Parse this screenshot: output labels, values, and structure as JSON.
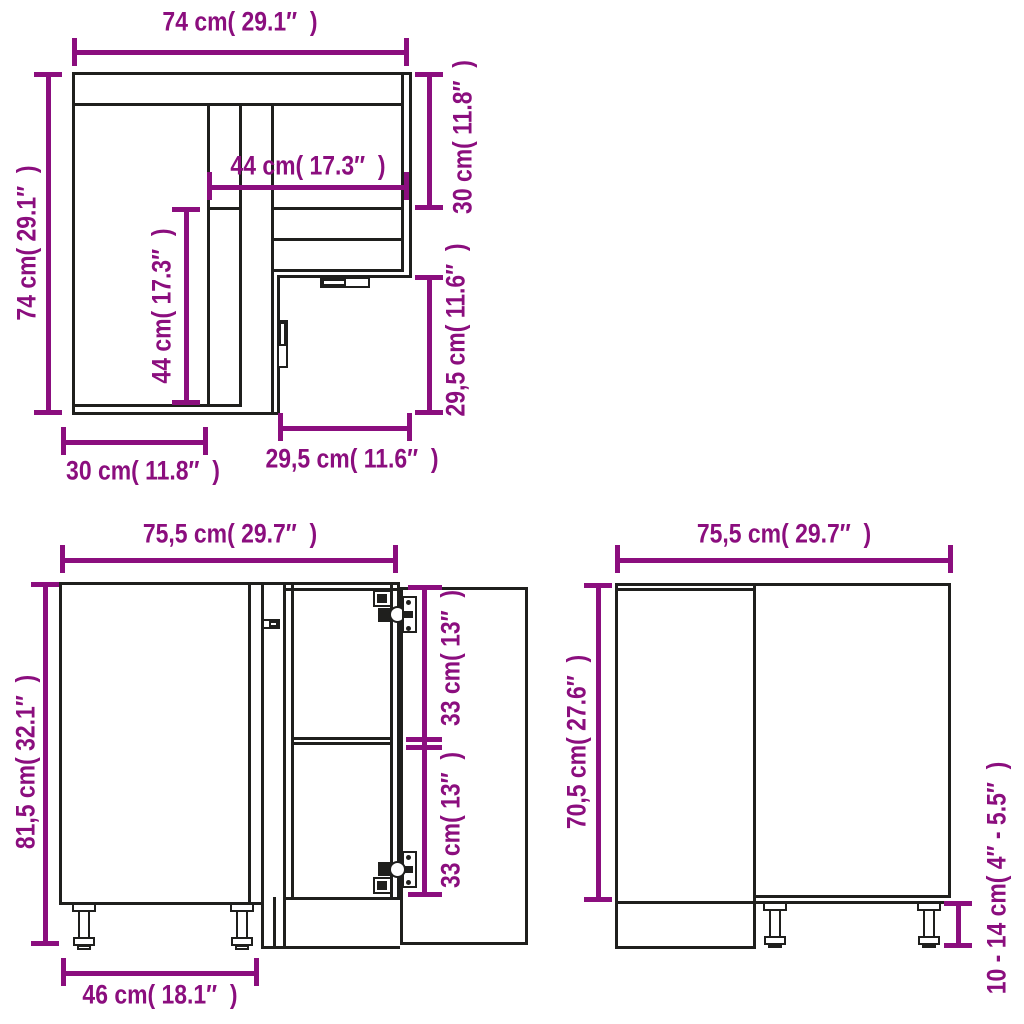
{
  "colors": {
    "dimension": "#8b0e7e",
    "line": "#1f1f1d",
    "background": "#ffffff"
  },
  "views": {
    "top": {
      "outer_width": "74 cm( 29.1″  )",
      "outer_depth": "74 cm( 29.1″  )",
      "inner_width": "44 cm( 17.3″  )",
      "inner_depth": "44 cm( 17.3″  )",
      "right_depth": "30 cm( 11.8″  )",
      "right_front": "29,5 cm( 11.6″  )",
      "bottom_left": "30 cm( 11.8″  )",
      "bottom_right": "29,5 cm( 11.6″  )"
    },
    "front": {
      "width": "75,5 cm( 29.7″  )",
      "height": "81,5 cm( 32.1″  )",
      "hinge_upper": "33 cm( 13″  )",
      "hinge_lower": "33 cm( 13″  )",
      "panel_width": "46 cm( 18.1″  )"
    },
    "side": {
      "width": "75,5 cm( 29.7″  )",
      "height": "70,5 cm( 27.6″  )",
      "leg_height": "10 - 14 cm( 4″ - 5.5″  )"
    }
  }
}
